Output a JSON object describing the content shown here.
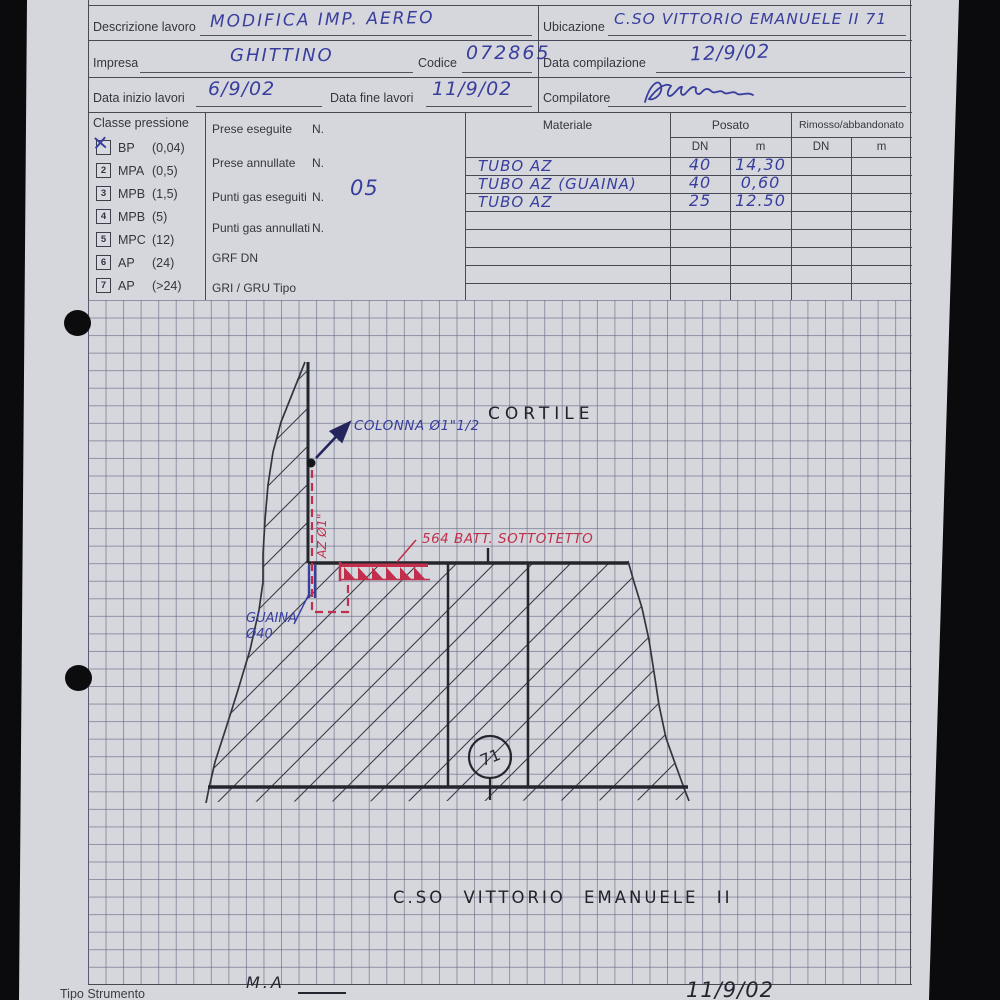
{
  "colors": {
    "paper": "#d6d7dd",
    "ink_blue": "#383e9d",
    "ink_red": "#c22f4c",
    "marker_black": "#26282f",
    "grid_line": "#606680",
    "form_line": "#474a55"
  },
  "header": {
    "descrizione": {
      "label": "Descrizione lavoro",
      "value": "MODIFICA IMP. AEREO"
    },
    "ubicazione": {
      "label": "Ubicazione",
      "value": "C.SO VITTORIO EMANUELE II 71"
    },
    "impresa": {
      "label": "Impresa",
      "value": "GHITTINO"
    },
    "codice": {
      "label": "Codice",
      "value": "072865"
    },
    "data_compilazione": {
      "label": "Data compilazione",
      "value": "12/9/02"
    },
    "data_inizio": {
      "label": "Data inizio lavori",
      "value": "6/9/02"
    },
    "data_fine": {
      "label": "Data fine lavori",
      "value": "11/9/02"
    },
    "compilatore": {
      "label": "Compilatore"
    }
  },
  "classe_pressione": {
    "title": "Classe pressione",
    "check_mark": "✕",
    "options": [
      {
        "num": "",
        "name": "BP",
        "range": "(0,04)",
        "checked": true
      },
      {
        "num": "2",
        "name": "MPA",
        "range": "(0,5)",
        "checked": false
      },
      {
        "num": "3",
        "name": "MPB",
        "range": "(1,5)",
        "checked": false
      },
      {
        "num": "4",
        "name": "MPB",
        "range": "(5)",
        "checked": false
      },
      {
        "num": "5",
        "name": "MPC",
        "range": "(12)",
        "checked": false
      },
      {
        "num": "6",
        "name": "AP",
        "range": "(24)",
        "checked": false
      },
      {
        "num": "7",
        "name": "AP",
        "range": "(>24)",
        "checked": false
      }
    ]
  },
  "contatori": {
    "rows": [
      {
        "label": "Prese eseguite",
        "unit": "N.",
        "value": ""
      },
      {
        "label": "Prese annullate",
        "unit": "N.",
        "value": ""
      },
      {
        "label": "Punti gas eseguiti",
        "unit": "N.",
        "value": "05"
      },
      {
        "label": "Punti gas annullati",
        "unit": "N.",
        "value": ""
      },
      {
        "label": "GRF DN",
        "unit": "",
        "value": ""
      },
      {
        "label": "GRI / GRU Tipo",
        "unit": "",
        "value": ""
      }
    ]
  },
  "materiale": {
    "col_materiale": "Materiale",
    "col_posato": "Posato",
    "col_rimosso": "Rimosso/abbandonato",
    "col_dn": "DN",
    "col_m": "m",
    "rows": [
      {
        "materiale": "TUBO AZ",
        "dn": "40",
        "m": "14,30"
      },
      {
        "materiale": "TUBO AZ (GUAINA)",
        "dn": "40",
        "m": "0,60"
      },
      {
        "materiale": "TUBO AZ",
        "dn": "25",
        "m": "12.50"
      }
    ],
    "empty_rows": 5
  },
  "sketch": {
    "cortile": "CORTILE",
    "colonna": "COLONNA Ø1\"1/2",
    "riser": "AZ Ø1\"",
    "batteria": "564 BATT. SOTTOTETTO",
    "guaina_line1": "GUAINA",
    "guaina_line2": "Ø40",
    "civico": "71",
    "street": "C.SO VITTORIO EMANUELE II"
  },
  "footer": {
    "tipo_strumento": "Tipo Strumento",
    "annotation": "M.A",
    "date": "11/9/02"
  }
}
